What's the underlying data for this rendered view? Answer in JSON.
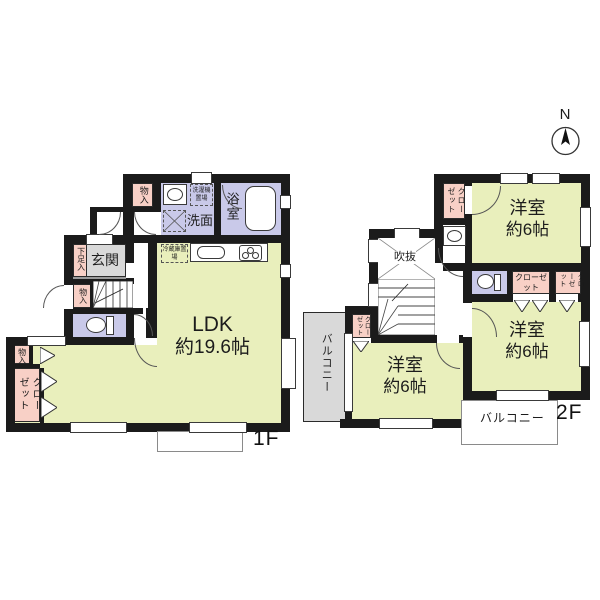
{
  "colors": {
    "wall": "#1b1b1b",
    "room_green": "#e9efbc",
    "wet_lavender": "#c9c9e9",
    "closet_pink": "#f8d0c6",
    "entry_gray": "#d9d9d9",
    "balcony_gray": "#d9d9d9"
  },
  "compass": {
    "north_label": "N"
  },
  "floor1": {
    "floor_label": "1F",
    "ldk": {
      "name": "LDK",
      "size": "約19.6帖"
    },
    "entrance": "玄関",
    "shoe_storage": "下足入",
    "washroom": "洗面",
    "bathroom": "浴室",
    "laundry_space": "洗濯機置場",
    "fridge_space": "冷蔵庫置場",
    "storage_upper": "物入",
    "storage_hall": "物入",
    "storage_lower": "物入",
    "closet": "クローゼット"
  },
  "floor2": {
    "floor_label": "2F",
    "room_ne": {
      "name": "洋室",
      "size": "約6帖"
    },
    "room_se": {
      "name": "洋室",
      "size": "約6帖"
    },
    "room_sw": {
      "name": "洋室",
      "size": "約6帖"
    },
    "void_space": "吹抜",
    "closet_nw": "クローゼット",
    "closet_center": "クローゼット",
    "closet_east": "クローゼット",
    "closet_stairs": "クローゼット",
    "balcony_west": "バルコニー",
    "balcony_south": "バルコニー"
  }
}
